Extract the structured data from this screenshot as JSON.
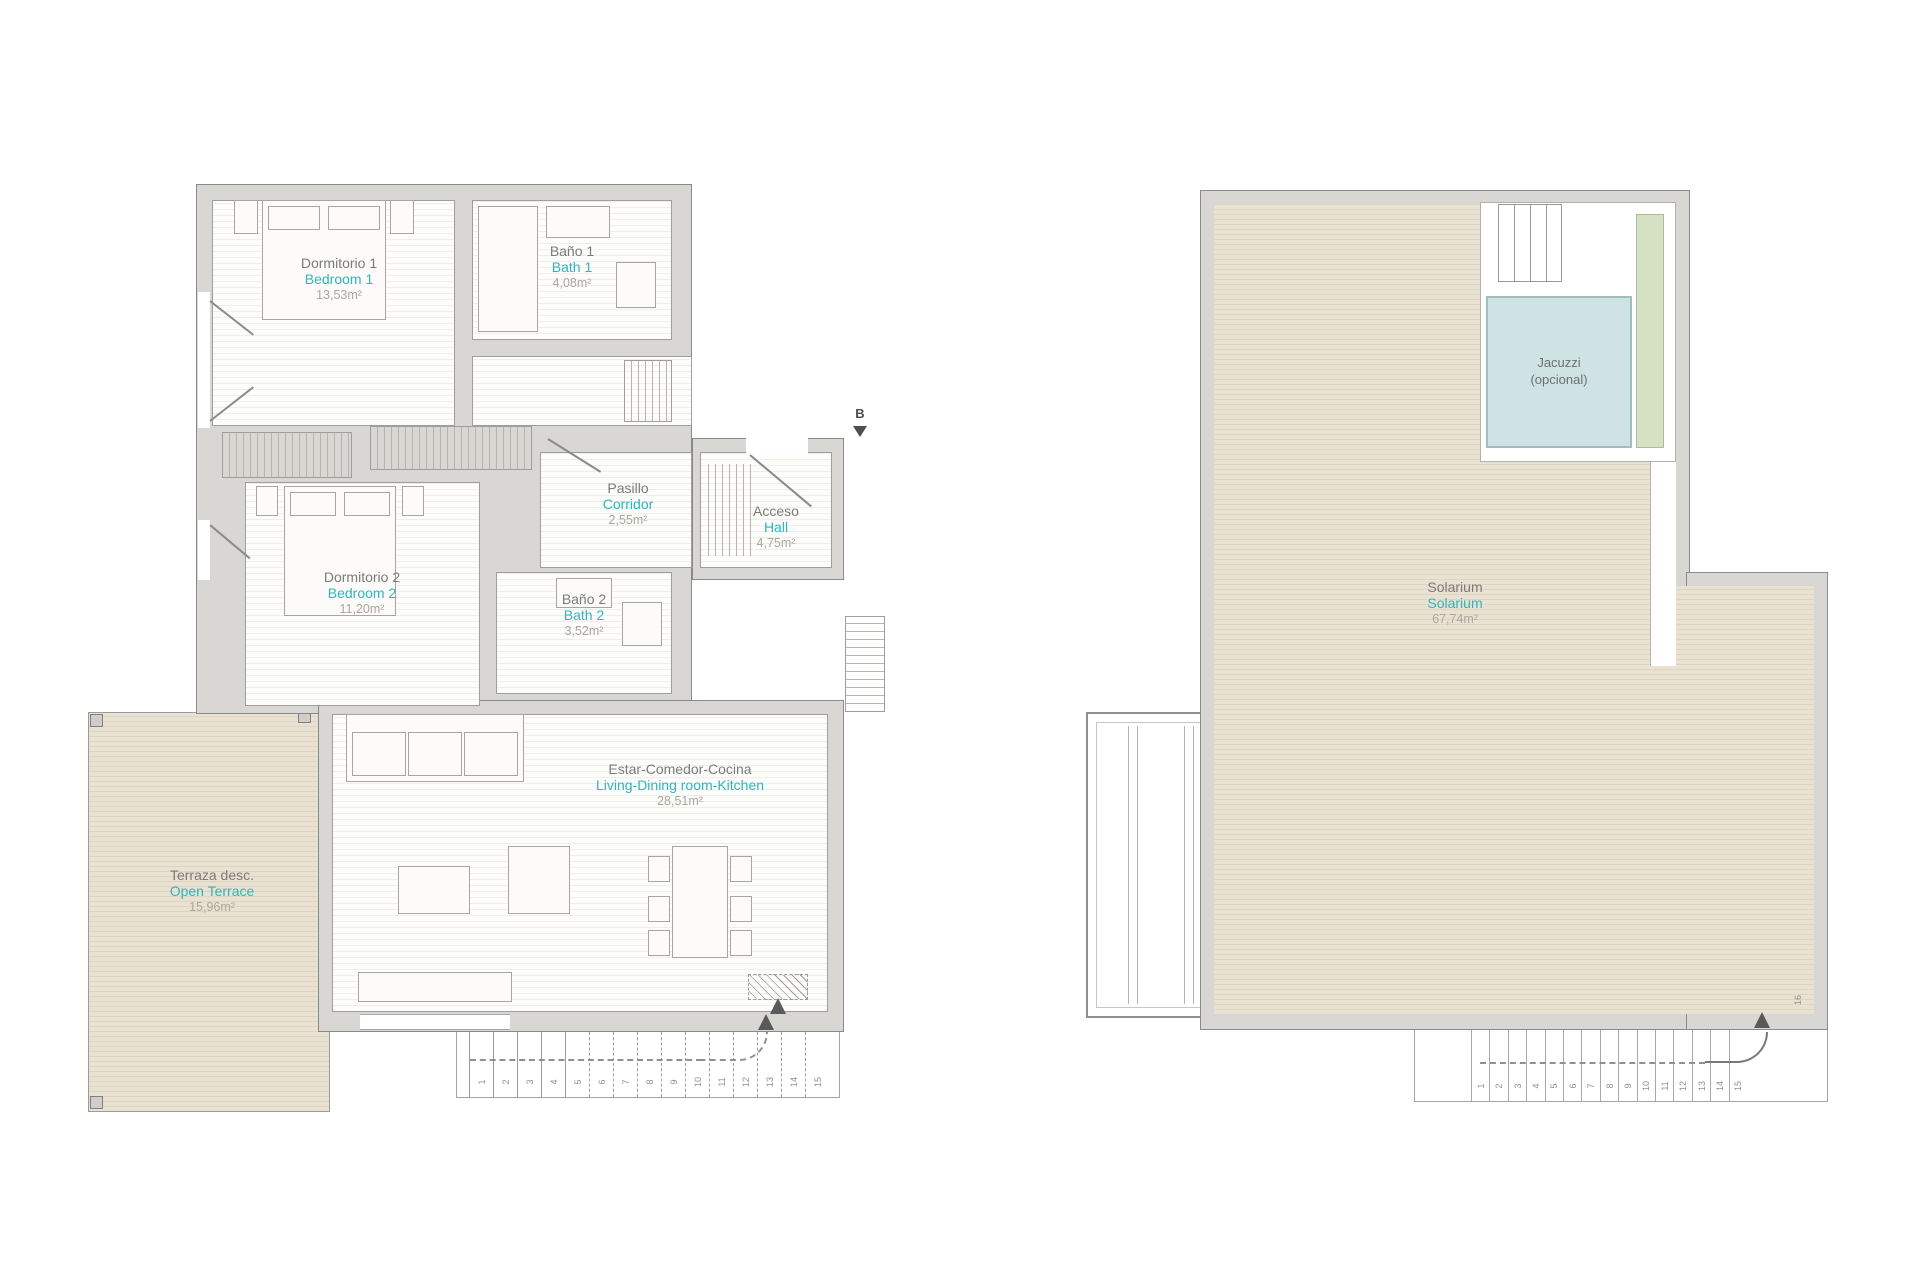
{
  "colors": {
    "accent_teal": "#2fb5bd",
    "room_name_gray": "#7b7b7b",
    "area_gray": "#aaa6a0",
    "wall_fill": "#d8d7d4",
    "wall_line": "#8a8a8a",
    "deck_fill": "#e9e2d3",
    "jacuzzi_fill": "#cfe3e5",
    "planter_fill": "#d6e0c3"
  },
  "floor_plan": {
    "rooms": {
      "bedroom1": {
        "name_es": "Dormitorio 1",
        "name_en": "Bedroom 1",
        "area": "13,53m²"
      },
      "bath1": {
        "name_es": "Baño 1",
        "name_en": "Bath 1",
        "area": "4,08m²"
      },
      "corridor": {
        "name_es": "Pasillo",
        "name_en": "Corridor",
        "area": "2,55m²"
      },
      "hall": {
        "name_es": "Acceso",
        "name_en": "Hall",
        "area": "4,75m²"
      },
      "bedroom2": {
        "name_es": "Dormitorio 2",
        "name_en": "Bedroom 2",
        "area": "11,20m²"
      },
      "bath2": {
        "name_es": "Baño 2",
        "name_en": "Bath 2",
        "area": "3,52m²"
      },
      "living": {
        "name_es": "Estar-Comedor-Cocina",
        "name_en": "Living-Dining room-Kitchen",
        "area": "28,51m²"
      },
      "terrace": {
        "name_es": "Terraza desc.",
        "name_en": "Open Terrace",
        "area": "15,96m²"
      }
    },
    "entrance_label": "B",
    "stair_numbers": [
      "1",
      "2",
      "3",
      "4",
      "5",
      "6",
      "7",
      "8",
      "9",
      "10",
      "11",
      "12",
      "13",
      "14",
      "15"
    ]
  },
  "solarium_plan": {
    "rooms": {
      "solarium": {
        "name_es": "Solarium",
        "name_en": "Solarium",
        "area": "67,74m²"
      },
      "jacuzzi": {
        "line1": "Jacuzzi",
        "line2": "(opcional)"
      }
    },
    "stair_numbers": [
      "1",
      "2",
      "3",
      "4",
      "5",
      "6",
      "7",
      "8",
      "9",
      "10",
      "11",
      "12",
      "13",
      "14",
      "15"
    ],
    "top_step_number": "16"
  }
}
